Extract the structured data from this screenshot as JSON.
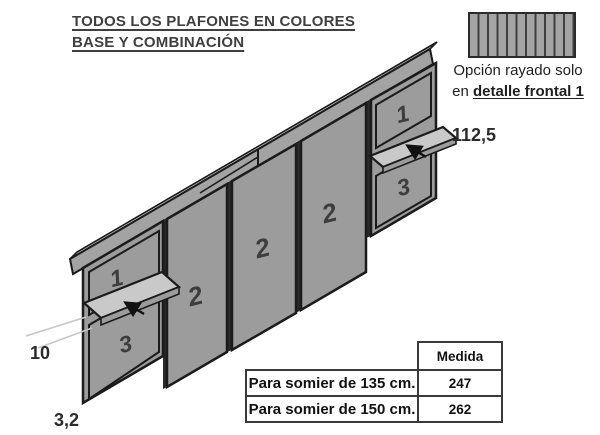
{
  "title": {
    "line1": "TODOS LOS PLAFONES EN COLORES",
    "line2": "BASE Y COMBINACIÓN"
  },
  "hatch_note": {
    "line1": "Opción rayado solo",
    "line2_prefix": "en ",
    "line2_emphasis": "detalle frontal 1"
  },
  "diagram": {
    "panel_labels": {
      "left_top": "1",
      "left_bottom": "3",
      "center_left": "2",
      "center_mid": "2",
      "center_right": "2",
      "right_top": "1",
      "right_bottom": "3"
    },
    "dimensions": {
      "height_to_shelf": "112,5",
      "shelf_depth": "10",
      "panel_thickness": "3,2"
    }
  },
  "size_table": {
    "header_value_col": "Medida",
    "rows": [
      {
        "label": "Para somier de 135 cm.",
        "value": "247"
      },
      {
        "label": "Para somier de 150 cm.",
        "value": "262"
      }
    ]
  },
  "colors": {
    "panel_fill": "#9c9c9c",
    "panel_outline": "#1b1b1b",
    "shelf_fill": "#c9c9c9",
    "rail_top_fill": "#c3c3c3",
    "rail_front_fill": "#a3a3a3",
    "hatch_stripe": "#404040",
    "dim_line": "#c6c6c6",
    "text_dark": "#2e2e2e"
  }
}
